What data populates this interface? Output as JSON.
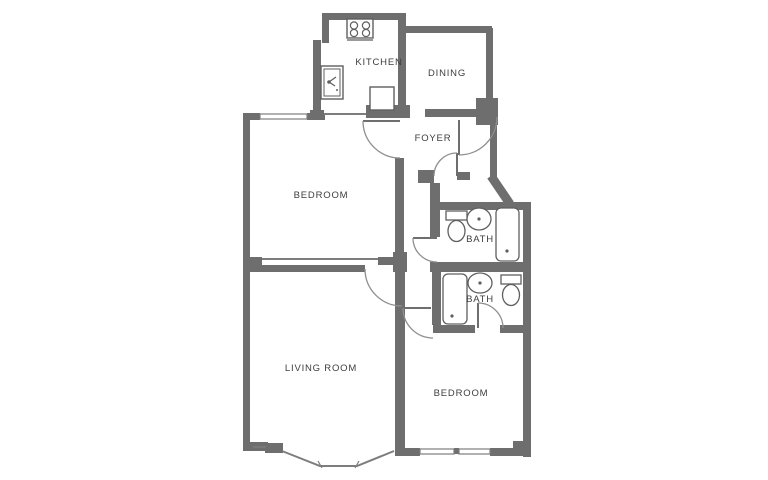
{
  "document": {
    "type": "floor-plan",
    "background": "#ffffff"
  },
  "colors": {
    "wall": "#6e6e6e",
    "thin_line": "#7d7d7d",
    "door_arc": "#8f8f8f",
    "fixture_stroke": "#5f5f5f",
    "label_text": "#3d3d3d"
  },
  "rooms": {
    "kitchen": {
      "label": "KITCHEN"
    },
    "dining": {
      "label": "DINING"
    },
    "foyer": {
      "label": "FOYER"
    },
    "bedroom_upper": {
      "label": "BEDROOM"
    },
    "bath_upper": {
      "label": "BATH"
    },
    "bath_lower": {
      "label": "BATH"
    },
    "living_room": {
      "label": "LIVING ROOM"
    },
    "bedroom_lower": {
      "label": "BEDROOM"
    }
  },
  "fixtures": [
    "stove-icon",
    "kitchen-sink-icon",
    "counter-appliance-icon",
    "toilet-icon",
    "bathroom-sink-icon",
    "bathtub-icon",
    "toilet-icon",
    "bathroom-sink-icon",
    "bathtub-icon"
  ],
  "features": [
    "entry-door",
    "hall-door",
    "bedroom-upper-door",
    "bath-upper-door",
    "living-room-door",
    "bedroom-lower-door",
    "bath-lower-door",
    "bay-window",
    "windows"
  ]
}
